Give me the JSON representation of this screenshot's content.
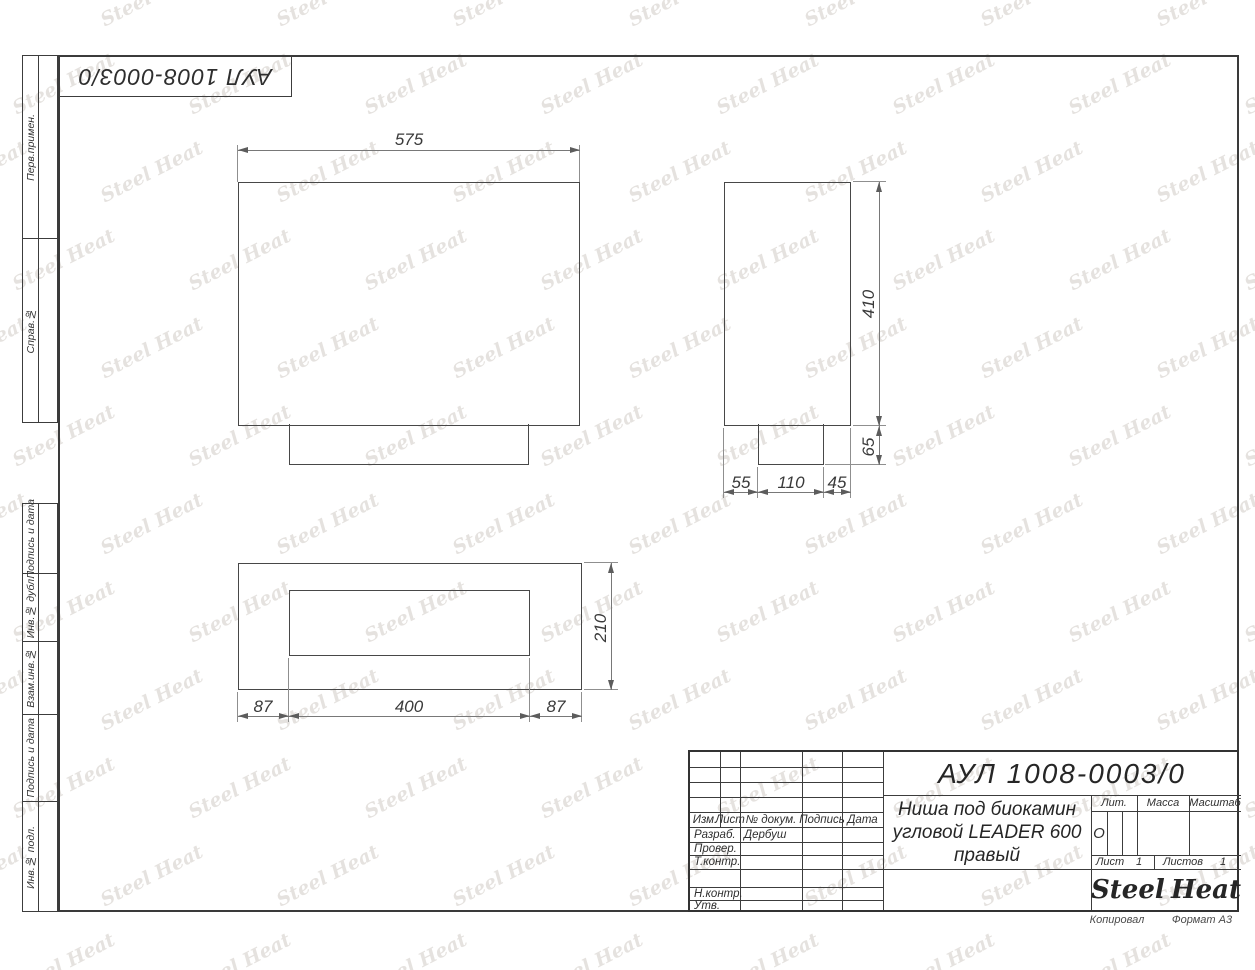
{
  "watermark": {
    "text": "Steel Heat"
  },
  "top_designation": "АУЛ 1008-0003/0",
  "margin_labels": [
    "Перв.примен.",
    "Справ.№",
    "Подпись и дата",
    "Инв.№ дубл.",
    "Взам.инв.№",
    "Подпись и дата",
    "Инв.№ подл."
  ],
  "dims": {
    "front_width": "575",
    "side_height": "410",
    "side_tab_height": "65",
    "side_left": "55",
    "side_mid": "110",
    "side_right": "45",
    "plan_depth": "210",
    "plan_left": "87",
    "plan_mid": "400",
    "plan_right": "87"
  },
  "title_block": {
    "designation": "АУЛ 1008-0003/0",
    "name_line1": "Ниша под биокамин",
    "name_line2": "угловой LEADER 600",
    "name_line3": "правый",
    "header": [
      "Изм.",
      "Лист",
      "№ докум.",
      "Подпись",
      "Дата"
    ],
    "developed_label": "Разраб.",
    "developed_by": "Дербуш",
    "checked_label": "Провер.",
    "tcontrol_label": "Т.контр.",
    "ncontrol_label": "Н.контр.",
    "approved_label": "Утв.",
    "lit_label": "Лит.",
    "lit_value": "О",
    "mass_label": "Масса",
    "scale_label": "Масштаб",
    "sheet_label": "Лист",
    "sheet_value": "1",
    "sheets_label": "Листов",
    "sheets_value": "1",
    "logo_left": "Steel",
    "logo_right": "Heat"
  },
  "sheet": {
    "copied": "Копировал",
    "format": "Формат А3"
  }
}
